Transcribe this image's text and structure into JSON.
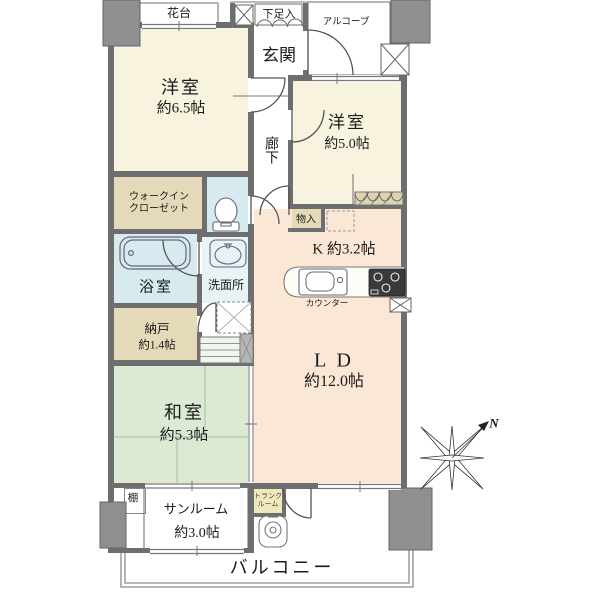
{
  "rooms": {
    "kadai": {
      "label": "花台"
    },
    "shitasokuire": {
      "label": "下足入"
    },
    "genkan": {
      "label": "玄関"
    },
    "alcove": {
      "label": "アルコーブ"
    },
    "yoshitsu65": {
      "label": "洋室",
      "size": "約6.5帖"
    },
    "roka": {
      "label": "廊下"
    },
    "yoshitsu50": {
      "label": "洋室",
      "size": "約5.0帖"
    },
    "monoire": {
      "label": "物入"
    },
    "wic": {
      "line1": "ウォークイン",
      "line2": "クローゼット"
    },
    "yokushitsu": {
      "label": "浴室"
    },
    "senmenjo": {
      "label": "洗面所"
    },
    "nando": {
      "label": "納戸",
      "size": "約1.4帖"
    },
    "kitchen": {
      "label": "K 約3.2帖"
    },
    "counter": {
      "label": "カウンター"
    },
    "ld": {
      "label": "L D",
      "size": "約12.0帖"
    },
    "washitsu": {
      "label": "和室",
      "size": "約5.3帖"
    },
    "tana": {
      "label": "棚"
    },
    "sunroom": {
      "label": "サンルーム",
      "size": "約3.0帖"
    },
    "trunk": {
      "line1": "トランク",
      "line2": "ルーム"
    },
    "balcony": {
      "label": "バルコニー"
    }
  },
  "compass": {
    "north_label": "N"
  },
  "colors": {
    "western_room": "#f7f3df",
    "closet_beige": "#e4d9b8",
    "wet_area_blue": "#d6eaf0",
    "washroom_blue": "#e8f3f5",
    "tatami_green": "#dcead4",
    "living_peach": "#fbe7d5",
    "trunk_yellow": "#efe9bb",
    "wall_gray": "#6e6e6e",
    "pillar_gray": "#8f8f8f"
  }
}
